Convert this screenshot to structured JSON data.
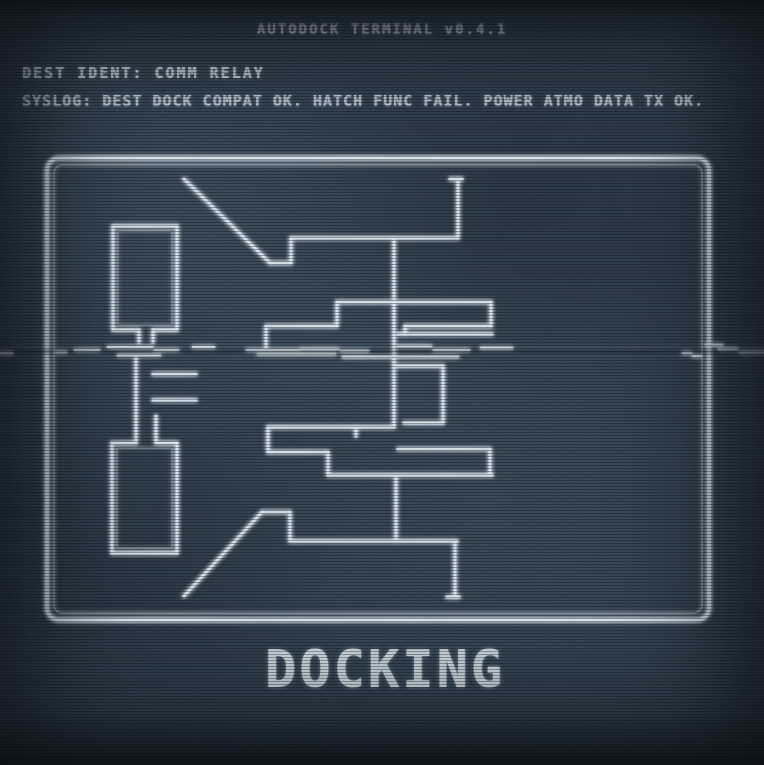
{
  "header": {
    "title": "AUTODOCK TERMINAL v0.4.1"
  },
  "info": {
    "dest_ident": "DEST IDENT: COMM RELAY",
    "syslog": "SYSLOG: DEST DOCK COMPAT OK. HATCH FUNC FAIL. POWER ATMO DATA TX OK."
  },
  "footer": {
    "status": "DOCKING"
  },
  "colors": {
    "background": "#2f3e4b",
    "line": "#e3edf4",
    "text": "#e8f1f6",
    "glow": "#b9d7f0"
  },
  "blueprint": {
    "frame": {
      "x": 47,
      "y": 158,
      "w": 662,
      "h": 462,
      "r": 12
    },
    "frame_inner": {
      "x": 54,
      "y": 165,
      "w": 648,
      "h": 448,
      "r": 8
    },
    "inner_rects": [
      {
        "x": 118,
        "y": 231,
        "w": 54,
        "h": 94
      },
      {
        "x": 117,
        "y": 448,
        "w": 55,
        "h": 100
      }
    ],
    "segments": [
      [
        113,
        226,
        177,
        226
      ],
      [
        113,
        226,
        113,
        330
      ],
      [
        177,
        226,
        177,
        330
      ],
      [
        113,
        330,
        139,
        330
      ],
      [
        153,
        330,
        177,
        330
      ],
      [
        139,
        330,
        139,
        342
      ],
      [
        153,
        330,
        153,
        342
      ],
      [
        184,
        179,
        270,
        263
      ],
      [
        270,
        263,
        291,
        263
      ],
      [
        291,
        238,
        291,
        263
      ],
      [
        291,
        238,
        458,
        238
      ],
      [
        458,
        179,
        458,
        238
      ],
      [
        450,
        179,
        462,
        179
      ],
      [
        394,
        238,
        394,
        427
      ],
      [
        337,
        302,
        491,
        302
      ],
      [
        337,
        302,
        337,
        326
      ],
      [
        266,
        326,
        337,
        326
      ],
      [
        266,
        326,
        266,
        347
      ],
      [
        491,
        302,
        491,
        326
      ],
      [
        405,
        326,
        491,
        326
      ],
      [
        405,
        326,
        405,
        334
      ],
      [
        398,
        334,
        492,
        334
      ],
      [
        394,
        366,
        443,
        366
      ],
      [
        443,
        366,
        443,
        423
      ],
      [
        404,
        423,
        443,
        423
      ],
      [
        268,
        427,
        394,
        427
      ],
      [
        268,
        427,
        268,
        452
      ],
      [
        268,
        452,
        328,
        452
      ],
      [
        328,
        452,
        328,
        475
      ],
      [
        328,
        475,
        492,
        475
      ],
      [
        356,
        427,
        356,
        436
      ],
      [
        398,
        449,
        490,
        449
      ],
      [
        490,
        449,
        490,
        475
      ],
      [
        396,
        475,
        396,
        541
      ],
      [
        290,
        541,
        457,
        541
      ],
      [
        290,
        512,
        290,
        541
      ],
      [
        262,
        512,
        290,
        512
      ],
      [
        184,
        596,
        262,
        512
      ],
      [
        455,
        541,
        455,
        597
      ],
      [
        447,
        597,
        459,
        597
      ],
      [
        112,
        443,
        135,
        443
      ],
      [
        157,
        443,
        177,
        443
      ],
      [
        112,
        443,
        112,
        553
      ],
      [
        177,
        443,
        177,
        553
      ],
      [
        112,
        553,
        177,
        553
      ],
      [
        136,
        359,
        136,
        443
      ],
      [
        156,
        416,
        156,
        443
      ],
      [
        153,
        374,
        196,
        374
      ],
      [
        153,
        400,
        196,
        400
      ]
    ],
    "crease_dashes": [
      [
        55,
        352,
        66,
        352
      ],
      [
        75,
        350,
        99,
        350
      ],
      [
        108,
        347,
        152,
        347
      ],
      [
        118,
        355,
        160,
        355
      ],
      [
        155,
        350,
        178,
        350
      ],
      [
        193,
        347,
        214,
        347
      ],
      [
        247,
        350,
        299,
        350
      ],
      [
        258,
        354,
        335,
        354
      ],
      [
        301,
        349,
        338,
        349
      ],
      [
        341,
        351,
        368,
        351
      ],
      [
        343,
        357,
        458,
        357
      ],
      [
        398,
        346,
        431,
        346
      ],
      [
        434,
        350,
        469,
        350
      ],
      [
        481,
        348,
        512,
        348
      ],
      [
        683,
        353,
        691,
        353
      ],
      [
        693,
        356,
        701,
        356
      ],
      [
        706,
        345,
        722,
        345
      ],
      [
        719,
        349,
        737,
        349
      ],
      [
        0,
        353,
        12,
        353
      ],
      [
        740,
        352,
        764,
        352
      ]
    ]
  }
}
